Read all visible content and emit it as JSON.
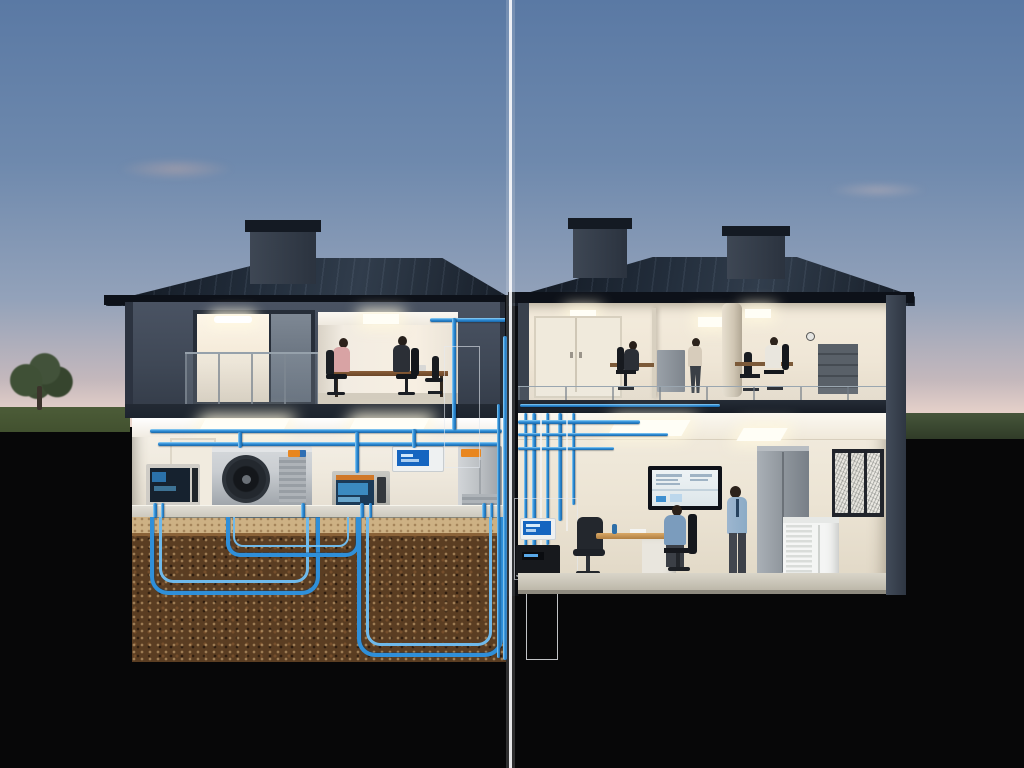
{
  "image": {
    "kind": "photorealistic cutaway illustration",
    "subject": "two-story office building cross-section at dusk with basement mechanical room, geothermal heat pump and underground pipe loops, split by a vertical comparison divider line",
    "visible_text": "none legible",
    "width": 1024,
    "height": 768
  },
  "colors": {
    "sky_top": "#5a79a4",
    "sky_horizon": "#e7d2ca",
    "ground_black": "#070708",
    "grass": "#42512f",
    "tree": "#42523a",
    "roof": "#1d2633",
    "fascia": "#0d1119",
    "facade": "#3f4856",
    "facade_dark": "#2c3340",
    "chimney_cap": "#141a23",
    "interior_warm": "#f7efe2",
    "interior_wall": "#efe9dd",
    "interior_ceiling": "#fbf8f1",
    "slab": "#1d242e",
    "soil_top": "#cdb184",
    "soil": "#5a3d22",
    "pipe": "#2f8fd9",
    "pipe_light": "#6fb9ea",
    "equip_light": "#c9cdd1",
    "equip_mid": "#9aa0a6",
    "screen_blue": "#1565c0",
    "screen_panel": "#1b3a57",
    "accent_orange": "#e8861f",
    "tv_frame": "#0e1118",
    "tv_screen": "#eef3f5",
    "desk_wood": "#8a5f3a",
    "desk_wood_light": "#d9a866",
    "chair": "#1b1f24",
    "suit": "#2b2f36",
    "shirt_pink": "#d8a3a4",
    "shirt_white": "#e9e6de",
    "shirt_blue": "#7b9cbd",
    "shirt_blue_light": "#9db6cf",
    "pants": "#42464e",
    "hair": "#2c221b",
    "cabinet": "#8f969d",
    "shelving": "#596068",
    "artwork_frame": "#21242b",
    "artwork_paper": "#e9e7e1",
    "white_unit": "#f4f5f4",
    "pallet": "#8a6f48",
    "divider": "#fafafc"
  }
}
